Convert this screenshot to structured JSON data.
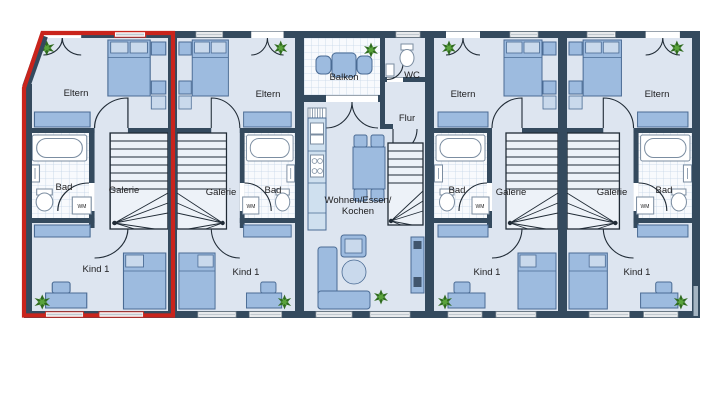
{
  "colors": {
    "wall": "#344a5e",
    "floor": "#dde5f0",
    "tile": "#f8fafd",
    "tile_line": "#c6d6e7",
    "furn": "#9dbbdf",
    "furn_stroke": "#4a6b94",
    "furn_light": "#c9d9ec",
    "counter": "#cfe0ef",
    "red": "#c9241c",
    "win_bar": "#c2c9cf",
    "plant_dark": "#2f6b1f",
    "plant_light": "#5aa33c",
    "text": "#1d1d1f"
  },
  "units": [
    {
      "id": "unit-1",
      "highlighted": true,
      "rooms": {
        "parents": "Eltern",
        "bath": "Bad",
        "gallery": "Galerie",
        "child": "Kind 1"
      },
      "washer": "WM"
    },
    {
      "id": "unit-2",
      "highlighted": false,
      "rooms": {
        "parents": "Eltern",
        "bath": "Bad",
        "gallery": "Galerie",
        "child": "Kind 1"
      },
      "washer": "WM"
    },
    {
      "id": "unit-3",
      "highlighted": false,
      "rooms": {
        "balcony": "Balkon",
        "wc": "WC",
        "hall": "Flur",
        "living_line1": "Wohnen/Essen/",
        "living_line2": "Kochen"
      }
    },
    {
      "id": "unit-4",
      "highlighted": false,
      "rooms": {
        "parents": "Eltern",
        "bath": "Bad",
        "gallery": "Galerie",
        "child": "Kind 1"
      },
      "washer": "WM"
    },
    {
      "id": "unit-5",
      "highlighted": false,
      "rooms": {
        "parents": "Eltern",
        "bath": "Bad",
        "gallery": "Galerie",
        "child": "Kind 1"
      },
      "washer": "WM"
    }
  ]
}
